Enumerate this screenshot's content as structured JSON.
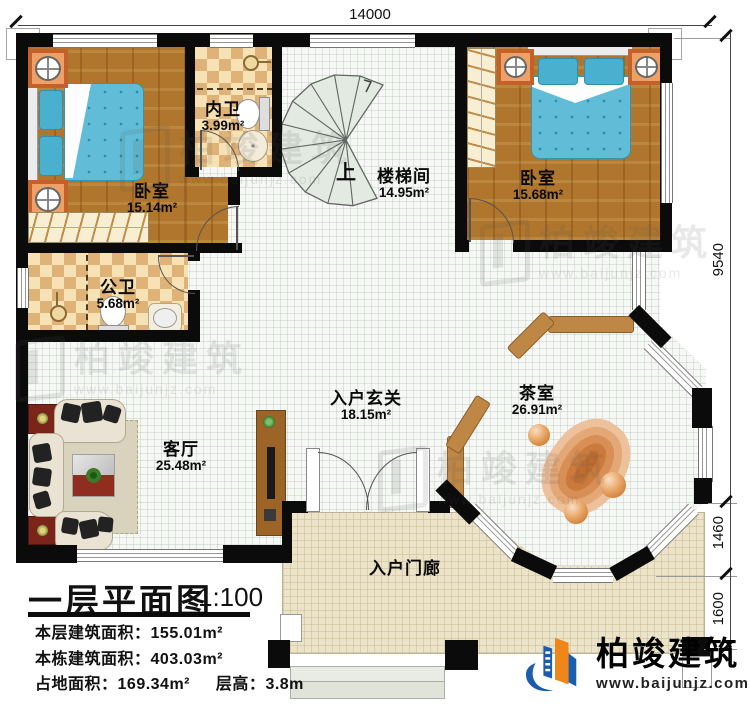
{
  "dims": {
    "top": "14000",
    "right_main": "9540",
    "right_mid": "1460",
    "right_low": "1600"
  },
  "rooms": {
    "bedroom_left": {
      "name": "卧室",
      "area": "15.14m²"
    },
    "bath_inner": {
      "name": "内卫",
      "area": "3.99m²"
    },
    "stairwell": {
      "name": "楼梯间",
      "area": "14.95m²"
    },
    "bedroom_right": {
      "name": "卧室",
      "area": "15.68m²"
    },
    "bath_public": {
      "name": "公卫",
      "area": "5.68m²"
    },
    "living": {
      "name": "客厅",
      "area": "25.48m²"
    },
    "foyer": {
      "name": "入户玄关",
      "area": "18.15m²"
    },
    "tea": {
      "name": "茶室",
      "area": "26.91m²"
    },
    "porch": {
      "name": "入户门廊"
    }
  },
  "stair": {
    "up": "上"
  },
  "titleblock": {
    "title": "一层平面图",
    "scale": "1:100",
    "line1_label": "本层建筑面积：",
    "line1_value": "155.01m²",
    "line2_label": "本栋建筑面积：",
    "line2_value": "403.03m²",
    "line3a_label": "占地面积：",
    "line3a_value": "169.34m²",
    "line3b_label": "层高：",
    "line3b_value": "3.8m"
  },
  "brand": {
    "name": "柏竣建筑",
    "url": "www.baijunjz.com"
  },
  "watermark": {
    "name": "柏竣建筑",
    "url": "www.baijunjz.com"
  },
  "colors": {
    "wall": "#0b0b0b",
    "wood": "#b0762d",
    "bed": "#5cbad6",
    "brand_blue": "#1c5cac",
    "brand_orange": "#f08518"
  }
}
